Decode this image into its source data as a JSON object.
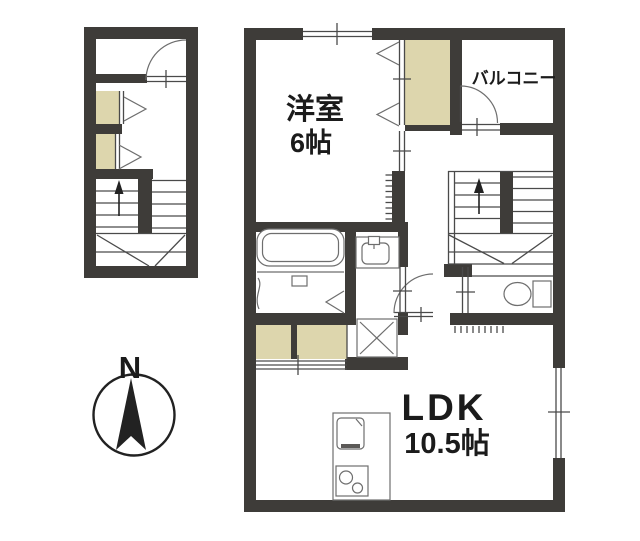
{
  "document": {
    "kind": "apartment floor plan"
  },
  "colors": {
    "bg": "#ffffff",
    "wall": "#3e3c39",
    "closet": "#ddd6ad",
    "line": "#4a4a4a",
    "fixture": "#6e6e6e",
    "text": "#1b1b1b"
  },
  "rooms": {
    "western_room": {
      "label": "洋室",
      "size": "6帖"
    },
    "balcony": {
      "label": "バルコニー"
    },
    "ldk": {
      "label": "LDK",
      "size": "10.5帖"
    }
  },
  "compass": {
    "north": "N"
  },
  "fixtures": [
    "entrance-door",
    "folding-closet-door",
    "staircase-up-arrow",
    "winder-staircase",
    "bathtub",
    "washbasin",
    "washing-machine-pan",
    "toilet",
    "kitchen-sink",
    "gas-stove",
    "sliding-closet-door",
    "window",
    "balcony-door",
    "hall-door"
  ]
}
